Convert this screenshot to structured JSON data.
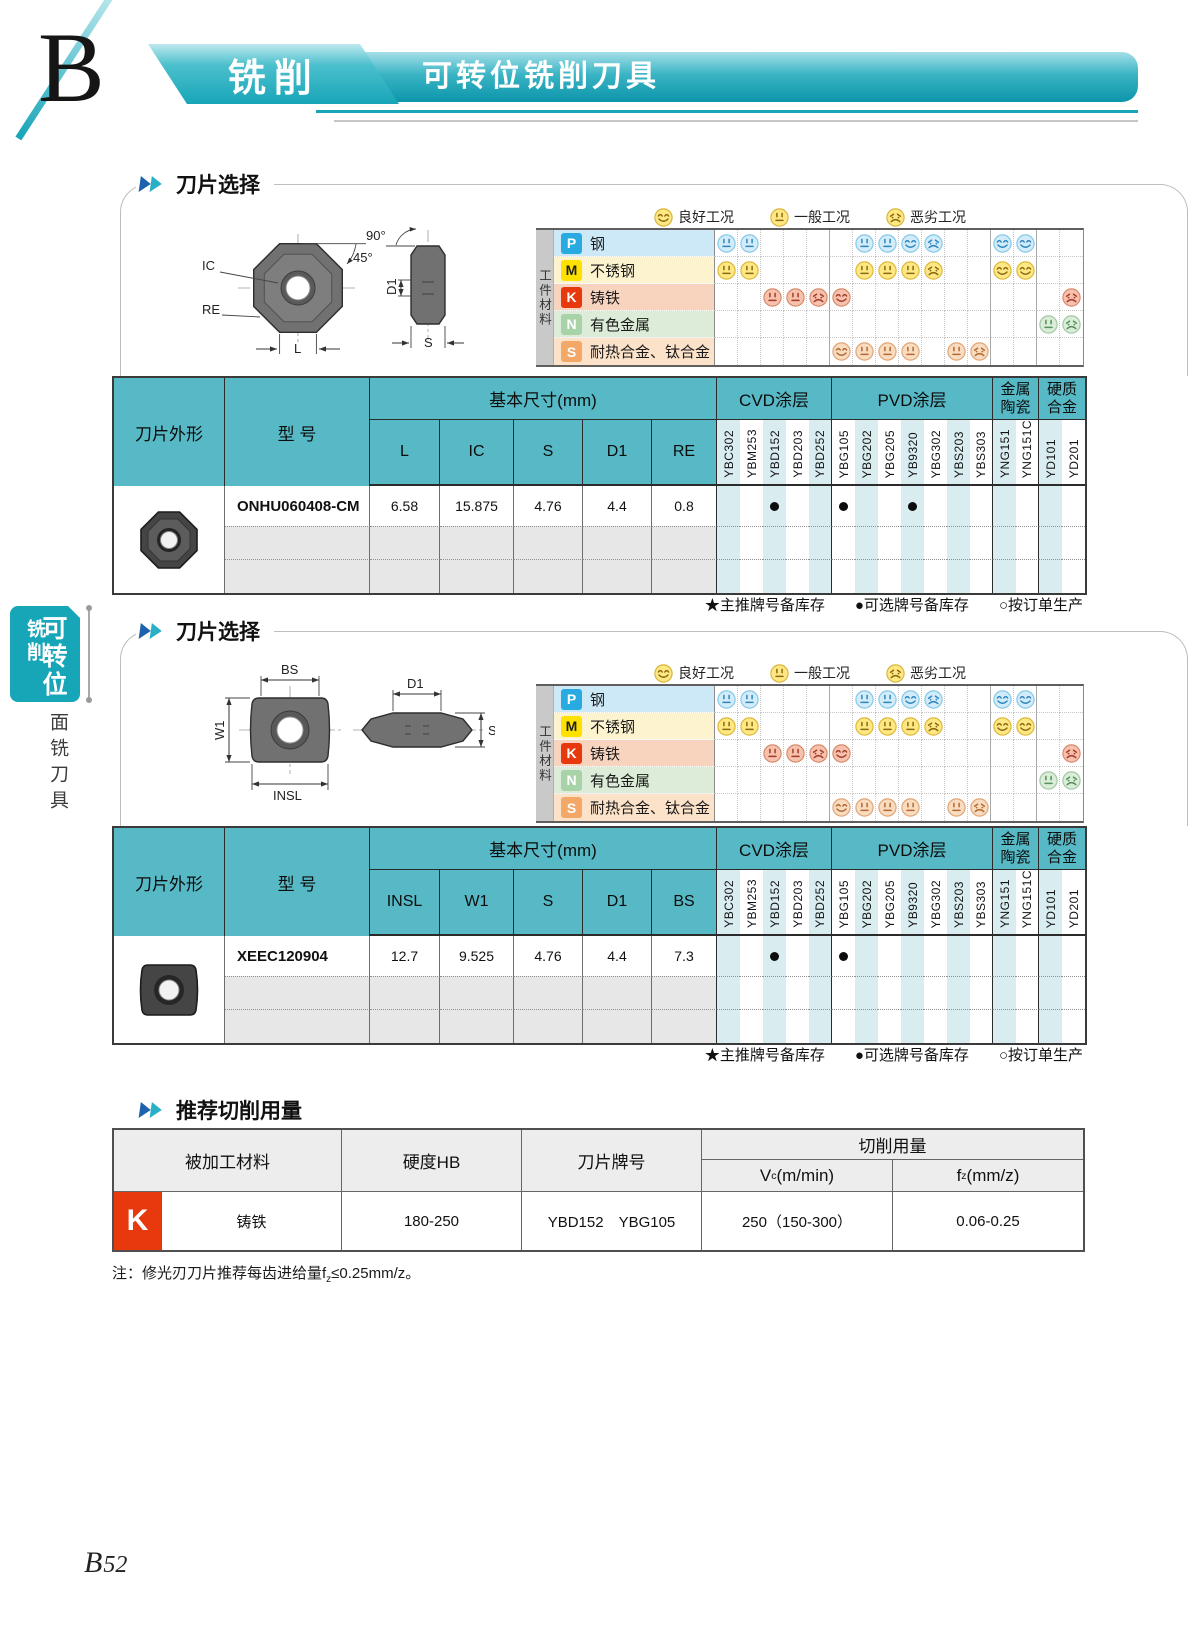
{
  "header": {
    "letter": "B",
    "category": "铣削",
    "title": "可转位铣削刀具"
  },
  "sidebar": {
    "tab_main": "可转位",
    "tab_sub": "铣削",
    "section": "面铣刀具"
  },
  "footer": {
    "page_letter": "B",
    "page_digits": "52"
  },
  "workpiece_label": "工件材料",
  "chart_legend": [
    {
      "type": "good",
      "label": "良好工况"
    },
    {
      "type": "avg",
      "label": "一般工况"
    },
    {
      "type": "bad",
      "label": "恶劣工况"
    }
  ],
  "grades": [
    "YBC302",
    "YBM253",
    "YBD152",
    "YBD203",
    "YBD252",
    "YBG105",
    "YBG202",
    "YBG205",
    "YB9320",
    "YBG302",
    "YBS203",
    "YBS303",
    "YNG151",
    "YNG151C",
    "YD101",
    "YD201"
  ],
  "grade_groups": [
    {
      "label": "CVD涂层",
      "span": 5
    },
    {
      "label": "PVD涂层",
      "span": 7
    },
    {
      "label": [
        "金属",
        "陶瓷"
      ],
      "span": 2
    },
    {
      "label": [
        "硬质",
        "合金"
      ],
      "span": 2
    }
  ],
  "table_headers": {
    "shape": "刀片外形",
    "model": "型 号",
    "sizes": "基本尺寸(mm)"
  },
  "stock_legend": [
    "★主推牌号备库存",
    "●可选牌号备库存",
    "○按订单生产"
  ],
  "materials": [
    {
      "code": "P",
      "label": "钢",
      "badge_bg": "#29abe2",
      "badge_fg": "#ffffff",
      "row_bg": "#cde9f8",
      "face": {
        "bg": "#d2ecfa",
        "ring": "#86c8e8",
        "fg": "#2e86c0"
      },
      "faces": [
        "avg",
        "avg",
        "",
        "",
        "",
        "",
        "avg",
        "avg",
        "good",
        "bad",
        "",
        "",
        "good",
        "good",
        "",
        ""
      ]
    },
    {
      "code": "M",
      "label": "不锈钢",
      "badge_bg": "#ffe100",
      "badge_fg": "#222222",
      "row_bg": "#fdf4cf",
      "face": {
        "bg": "#ffe883",
        "ring": "#ddb93a",
        "fg": "#8a6a10"
      },
      "faces": [
        "avg",
        "avg",
        "",
        "",
        "",
        "",
        "avg",
        "avg",
        "avg",
        "bad",
        "",
        "",
        "good",
        "good",
        "",
        ""
      ]
    },
    {
      "code": "K",
      "label": "铸铁",
      "badge_bg": "#e8380d",
      "badge_fg": "#ffffff",
      "row_bg": "#f8d4bf",
      "face": {
        "bg": "#f6c2ae",
        "ring": "#d98a6d",
        "fg": "#a63c28"
      },
      "faces": [
        "",
        "",
        "avg",
        "avg",
        "bad",
        "good",
        "",
        "",
        "",
        "",
        "",
        "",
        "",
        "",
        "",
        "bad"
      ]
    },
    {
      "code": "N",
      "label": "有色金属",
      "badge_bg": "#a8d3a9",
      "badge_fg": "#ffffff",
      "row_bg": "#dcecd8",
      "face": {
        "bg": "#d9edd9",
        "ring": "#a2c9a4",
        "fg": "#56905b"
      },
      "faces": [
        "",
        "",
        "",
        "",
        "",
        "",
        "",
        "",
        "",
        "",
        "",
        "",
        "",
        "",
        "avg",
        "bad"
      ]
    },
    {
      "code": "S",
      "label": "耐热合金、钛合金",
      "badge_bg": "#f4a868",
      "badge_fg": "#ffffff",
      "row_bg": "#fbe2c9",
      "face": {
        "bg": "#f9dcc0",
        "ring": "#e0a678",
        "fg": "#b06a33"
      },
      "faces": [
        "",
        "",
        "",
        "",
        "",
        "good",
        "avg",
        "avg",
        "avg",
        "",
        "avg",
        "bad",
        "",
        "",
        "",
        ""
      ]
    }
  ],
  "sections": [
    {
      "title": "刀片选择",
      "dims": [
        "L",
        "IC",
        "S",
        "D1",
        "RE"
      ],
      "thumb": "octagon",
      "diagram_labels": {
        "ic": "IC",
        "re": "RE",
        "l": "L",
        "angle45": "45°",
        "angle90": "90°",
        "d1": "D1",
        "s": "S"
      },
      "rows": [
        {
          "model": "ONHU060408-CM",
          "sizes": [
            "6.58",
            "15.875",
            "4.76",
            "4.4",
            "0.8"
          ],
          "dots": [
            2,
            5,
            8
          ]
        }
      ]
    },
    {
      "title": "刀片选择",
      "dims": [
        "INSL",
        "W1",
        "S",
        "D1",
        "BS"
      ],
      "thumb": "square",
      "diagram_labels": {
        "bs": "BS",
        "w1": "W1",
        "insl": "INSL",
        "d1": "D1",
        "s": "S"
      },
      "rows": [
        {
          "model": "XEEC120904",
          "sizes": [
            "12.7",
            "9.525",
            "4.76",
            "4.4",
            "7.3"
          ],
          "dots": [
            2,
            5
          ]
        }
      ]
    }
  ],
  "cutting": {
    "title": "推荐切削用量",
    "headers": {
      "material": "被加工材料",
      "hardness": "硬度HB",
      "grade": "刀片牌号",
      "params": "切削用量",
      "vc": {
        "base": "V",
        "sub": "c",
        "unit": "(m/min)"
      },
      "fz": {
        "base": "f",
        "sub": "z",
        "unit": "(mm/z)"
      }
    },
    "rows": [
      {
        "code": "K",
        "material": "铸铁",
        "hardness": "180-250",
        "grades": "YBD152　YBG105",
        "vc": "250（150-300）",
        "fz": "0.06-0.25"
      }
    ],
    "note": {
      "pre": "注：修光刃刀片推荐每齿进给量f",
      "sub": "z",
      "post": "≤0.25mm/z。"
    }
  },
  "colors": {
    "accent": "#17a5b8",
    "table_header": "#56b9c5",
    "stripe": "#d9edf1",
    "frame": "#bdbdbd",
    "empty_row": "#e7e7e7",
    "badge_red": "#e8380d",
    "title_icon_blue": "#1e62ad",
    "title_icon_teal": "#28b0c6",
    "legend_face": {
      "bg": "#ffe883",
      "ring": "#d9b63a",
      "fg": "#8a6a12"
    }
  }
}
